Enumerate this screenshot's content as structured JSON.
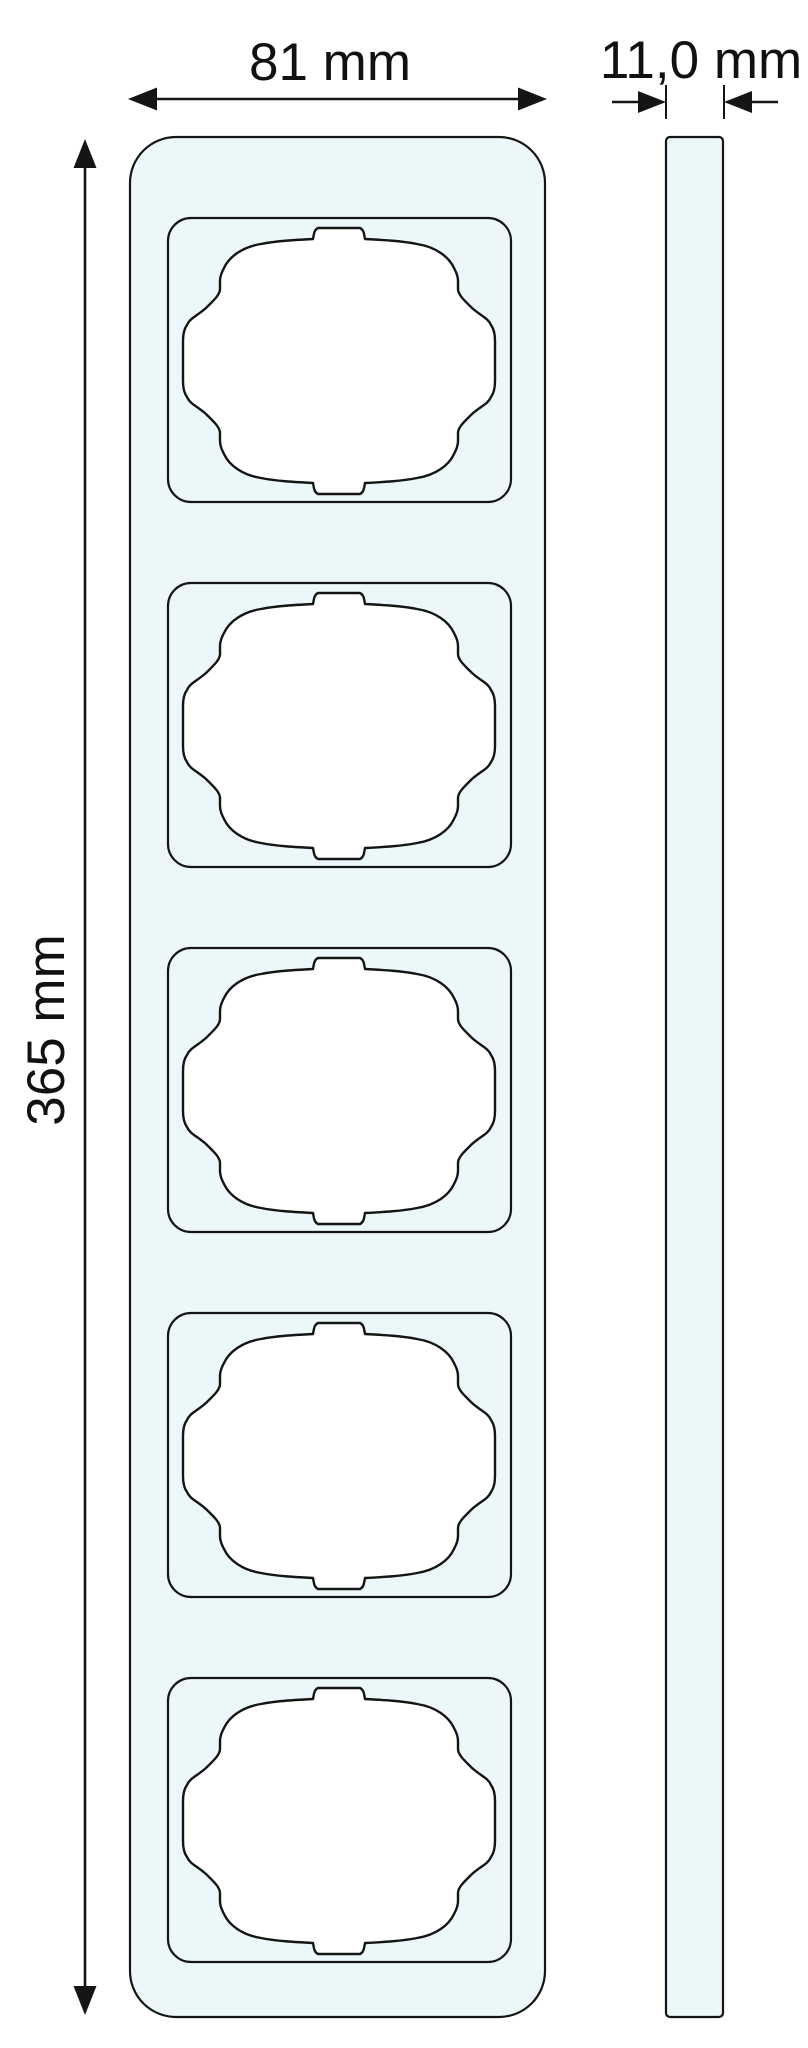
{
  "drawing": {
    "type": "dimension-drawing",
    "colors": {
      "fill": "#ecf7f9",
      "line": "#151515",
      "background": "#ffffff"
    },
    "front_view": {
      "gang_count": 5
    },
    "dimensions": {
      "width": {
        "label": "81 mm"
      },
      "depth": {
        "label": "11,0 mm"
      },
      "height": {
        "label": "365 mm"
      }
    }
  }
}
